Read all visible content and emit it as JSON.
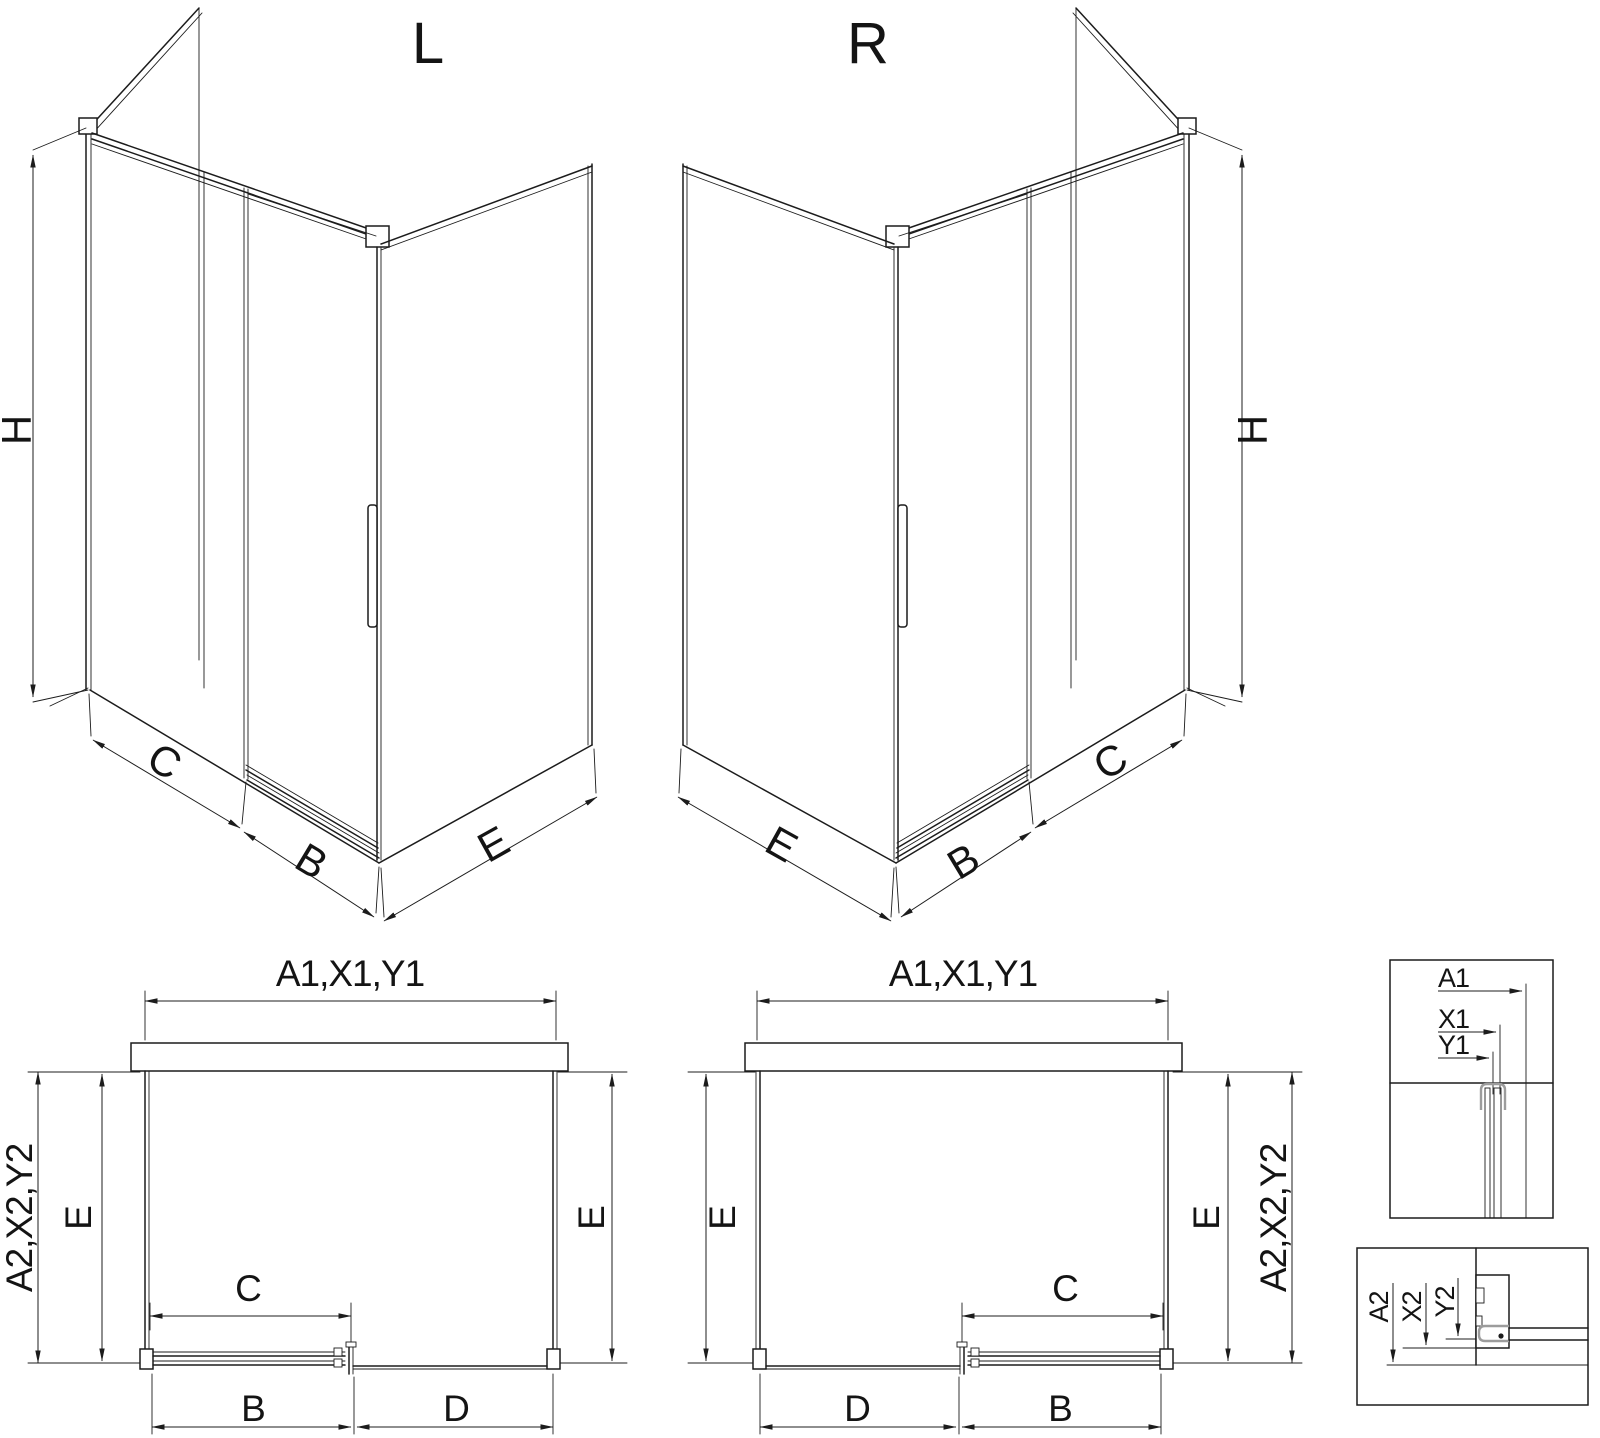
{
  "drawing": {
    "background": "#ffffff",
    "line_color": "#1c1c1c",
    "hardware_color": "#9c9c9c",
    "views": {
      "iso_left": {
        "view_label": "L",
        "dims": {
          "height": "H",
          "fixed_width": "C",
          "door_width": "B",
          "side_width": "E"
        }
      },
      "iso_right": {
        "view_label": "R",
        "dims": {
          "height": "H",
          "fixed_width": "C",
          "door_width": "B",
          "side_width": "E"
        }
      },
      "plan_left": {
        "dims": {
          "front_total": "A1,X1,Y1",
          "depth_total": "A2,X2,Y2",
          "side_left": "E",
          "side_right": "E",
          "fixed": "C",
          "door": "B",
          "opening": "D"
        }
      },
      "plan_right": {
        "dims": {
          "front_total": "A1,X1,Y1",
          "depth_total": "A2,X2,Y2",
          "side_left": "E",
          "side_right": "E",
          "fixed": "C",
          "door": "B",
          "opening": "D"
        }
      },
      "detail_wall_profile": {
        "dims": {
          "total": "A1",
          "mid": "X1",
          "inner": "Y1"
        }
      },
      "detail_floor_profile": {
        "dims": {
          "total": "A2",
          "mid": "X2",
          "inner": "Y2"
        }
      }
    }
  }
}
